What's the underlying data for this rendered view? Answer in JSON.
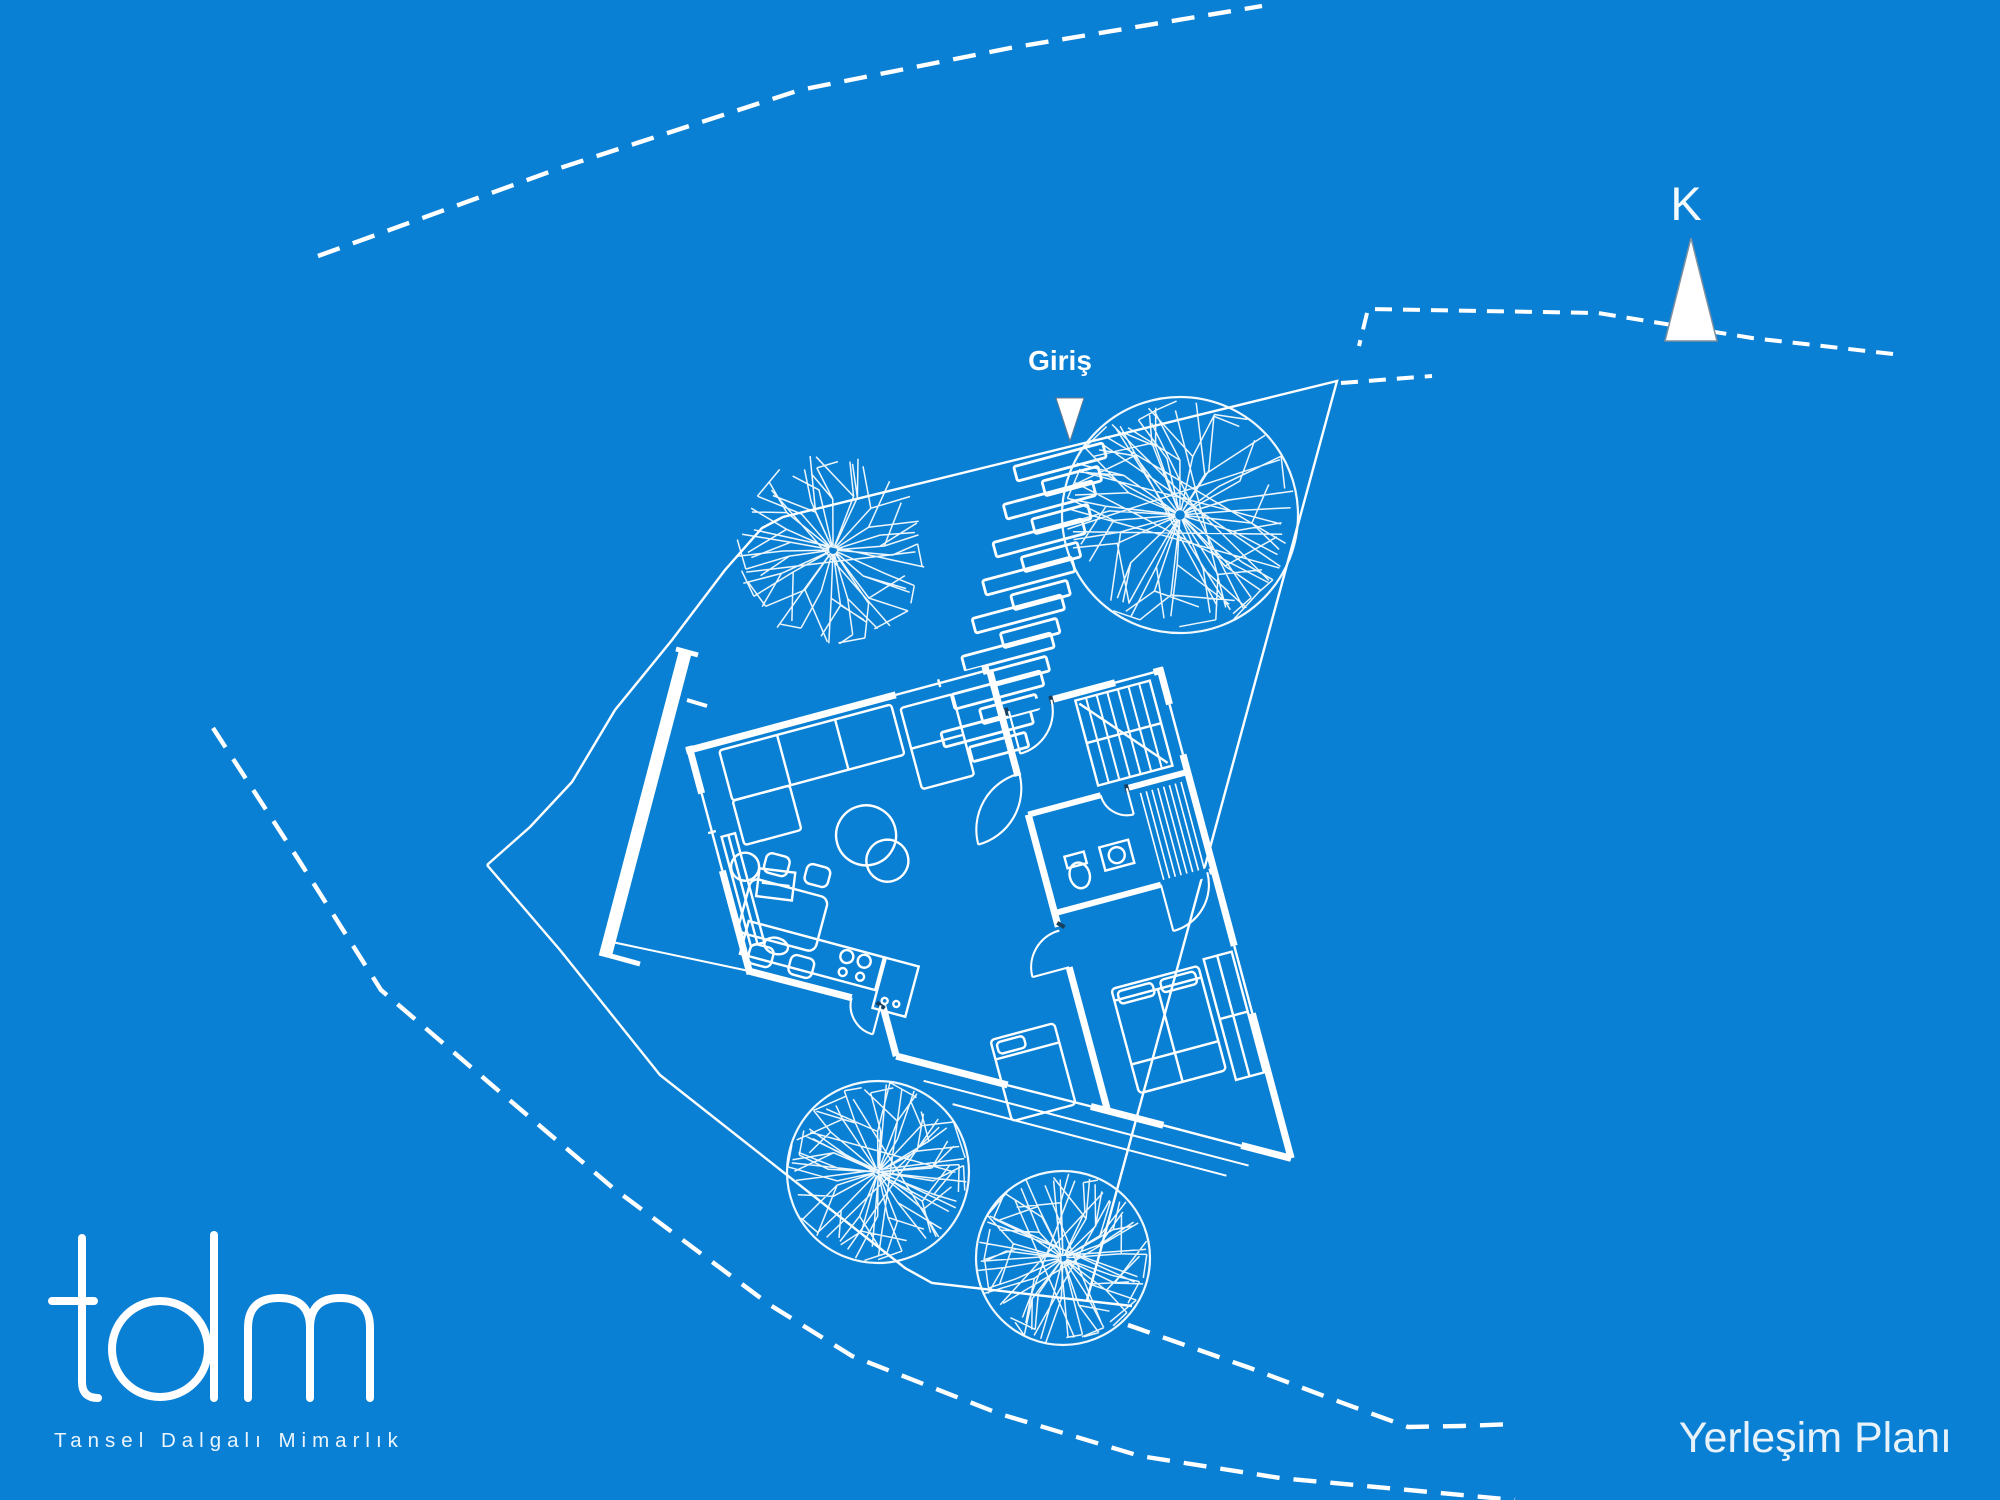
{
  "canvas": {
    "background_color": "#0A80D5",
    "line_color": "#FFFFFF",
    "width": 2000,
    "height": 1500
  },
  "labels": {
    "entrance": "Giriş",
    "north": "K",
    "drawing_title": "Yerleşim Planı"
  },
  "logo": {
    "wordmark": "tdm",
    "subtitle": "Tansel Dalgalı Mimarlık"
  },
  "icons": {
    "north_arrow": "north-arrow-icon",
    "entrance_marker": "entrance-marker-icon",
    "trees": [
      "tree-icon-left",
      "tree-icon-large-entrance",
      "tree-icon-bottom-left",
      "tree-icon-bottom-right"
    ]
  }
}
